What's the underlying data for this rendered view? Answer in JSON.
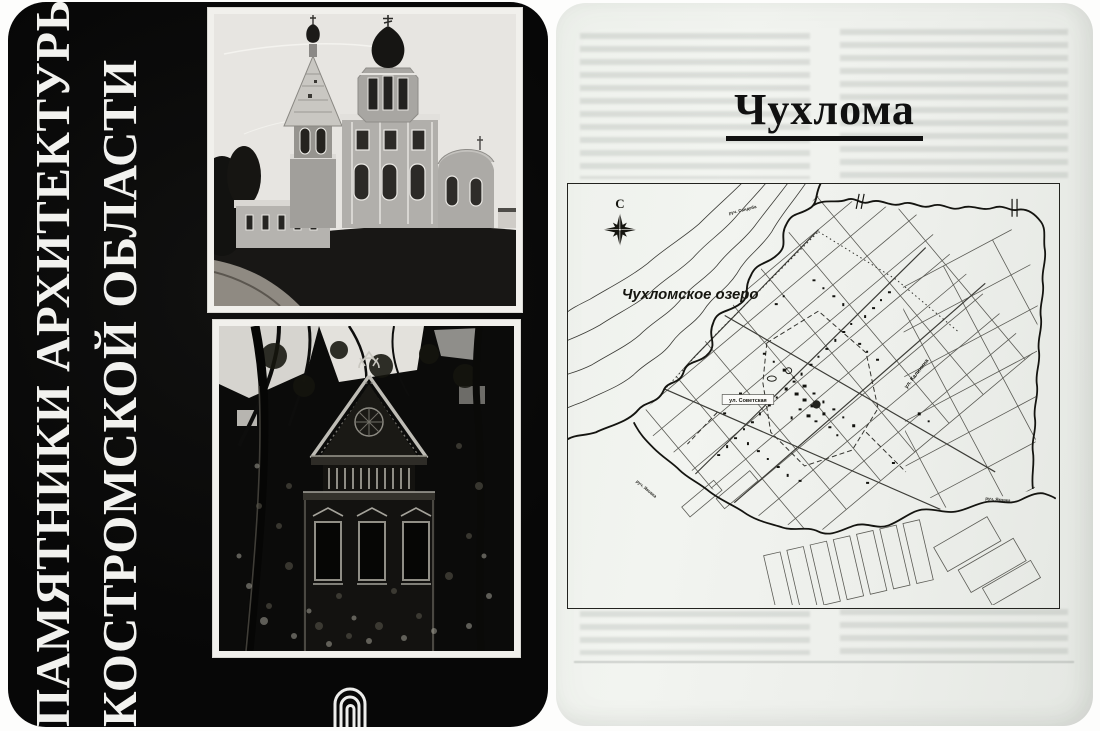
{
  "cover": {
    "title_line1": "ПАМЯТНИКИ АРХИТЕКТУРЫ",
    "title_line2": "КОСТРОМСКОЙ ОБЛАСТИ",
    "photos": [
      {
        "name": "stone-church-with-tent-belfry-photo"
      },
      {
        "name": "carved-wooden-terem-house-photo"
      }
    ],
    "logo_name": "nested-arches-publisher-logo"
  },
  "page": {
    "title": "Чухлома",
    "map": {
      "compass": "С",
      "lake": "Чухломское озеро",
      "stream_north": "руч. Сандеба",
      "stream_southwest": "руч. Яковка",
      "stream_southeast": "руч. Яковка",
      "street_sovetskaya": "ул. Советская",
      "street_kalinina": "ул. Калинина"
    }
  },
  "colors": {
    "cover_background": "#0a0a0a",
    "cover_text": "#f2f2ef",
    "page_background": "#eef1ec",
    "map_ink": "#1a1a16"
  }
}
